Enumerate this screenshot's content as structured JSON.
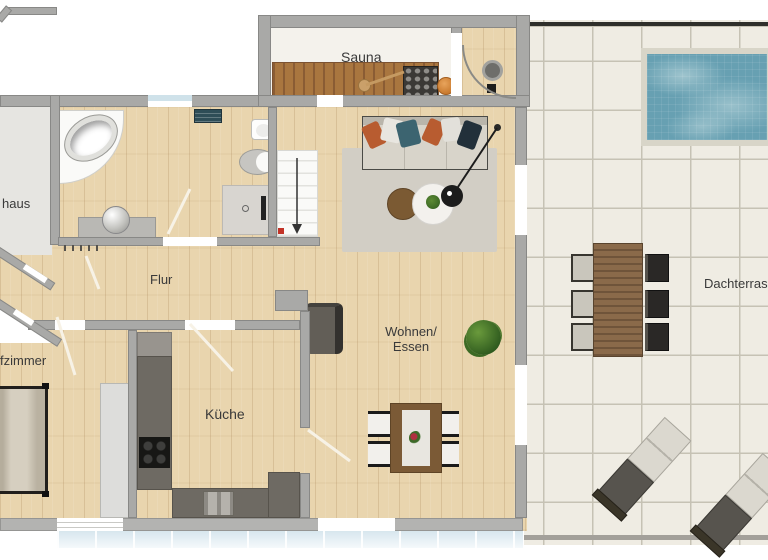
{
  "plan": {
    "title": "apartment-floor-plan",
    "labels": {
      "sauna": "Sauna",
      "haus_partial": "haus",
      "zimmer_partial": "fzimmer",
      "flur": "Flur",
      "kueche": "Küche",
      "wohnen_line1": "Wohnen/",
      "wohnen_line2": "Essen",
      "dachterrasse_partial": "Dachterras"
    },
    "colors": {
      "wall": "#a9a9a7",
      "wood_floor": "#e9d5ae",
      "terrace_tile": "#efece3",
      "pool_water": "#67a0b2",
      "sauna_bench": "#a9763f",
      "kitchen_counter": "#6e6a63",
      "rug": "#d2cec5",
      "table_brown": "#7b5a36",
      "stair_marker_red": "#c23327"
    }
  }
}
